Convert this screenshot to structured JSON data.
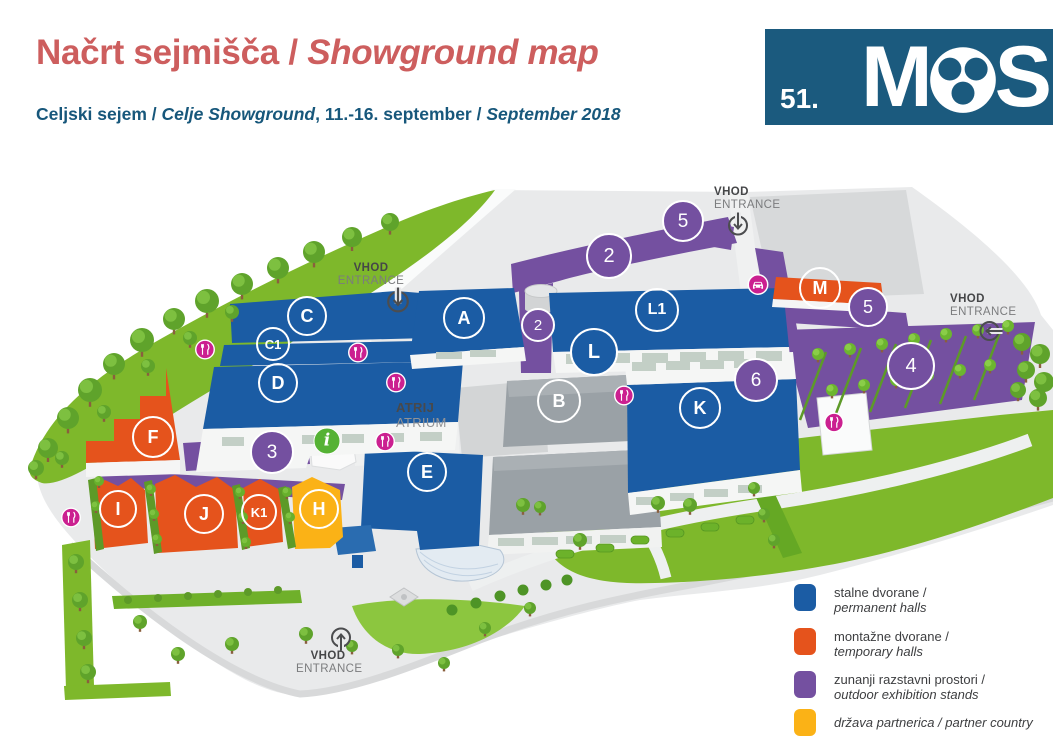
{
  "header": {
    "title": {
      "part1": "Načrt sejmišča / ",
      "part2": "Showground map"
    },
    "subtitle": {
      "part1": "Celjski sejem / ",
      "part2": "Celje Showground",
      "part3": ", 11.-16. september / ",
      "part4": "September 2018"
    }
  },
  "logo": {
    "number": "51.",
    "m": "M",
    "s": "S"
  },
  "map": {
    "atrium": {
      "sl": "ATRIJ",
      "en": "ATRIUM"
    },
    "entrances": [
      {
        "vhod": "VHOD",
        "entrance": "ENTRANCE"
      },
      {
        "vhod": "VHOD",
        "entrance": "ENTRANCE"
      },
      {
        "vhod": "VHOD",
        "entrance": "ENTRANCE"
      },
      {
        "vhod": "VHOD",
        "entrance": "ENTRANCE"
      }
    ],
    "halls": {
      "a": "A",
      "b": "B",
      "c": "C",
      "c1": "C1",
      "d": "D",
      "e": "E",
      "f": "F",
      "h": "H",
      "i": "I",
      "j": "J",
      "k": "K",
      "k1": "K1",
      "l": "L",
      "l1": "L1",
      "m": "M"
    },
    "areas": {
      "n2a": "2",
      "n2b": "2",
      "n3": "3",
      "n4": "4",
      "n5a": "5",
      "n5b": "5",
      "n6": "6"
    },
    "icons": {
      "restaurant": "fork-knife",
      "info": "i",
      "car": "car",
      "entrance": "arrow-circle"
    }
  },
  "legend": {
    "items": [
      {
        "color": "#1b5ca4",
        "line1": "stalne dvorane /",
        "line2": "permanent halls"
      },
      {
        "color": "#e5531c",
        "line1": "montažne dvorane /",
        "line2": "temporary halls"
      },
      {
        "color": "#7450a0",
        "line1": "zunanji razstavni prostori /",
        "line2": "outdoor exhibition stands"
      },
      {
        "color": "#fbb216",
        "line1": "država partnerica / partner country",
        "line2": ""
      }
    ]
  },
  "colors": {
    "permanent_hall": "#1b5ca4",
    "temporary_hall": "#e5531c",
    "outdoor_stand": "#7450a0",
    "partner_country": "#fbb216",
    "title": "#cd5e5e",
    "subtitle": "#17577b",
    "logo_bg": "#1b5a7e",
    "restaurant_icon": "#cb2090",
    "info_icon": "#55b234",
    "grass": "#7eb82b",
    "ground": "#e9eaeb",
    "gray_hall": "#9aa1a6"
  }
}
